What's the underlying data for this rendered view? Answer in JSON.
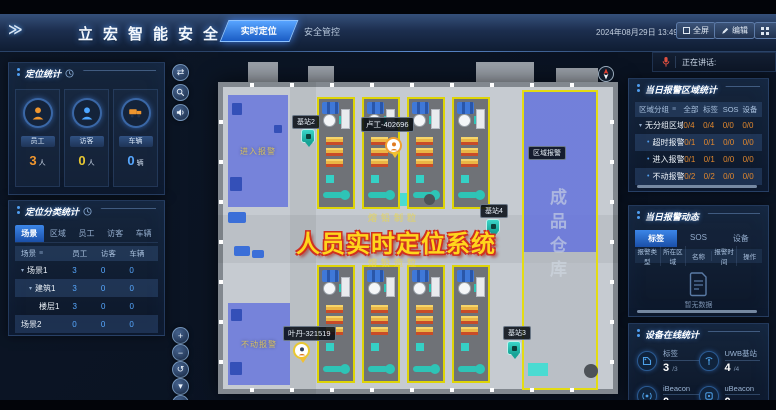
{
  "header": {
    "logo": "立宏智能安全",
    "tabs": [
      {
        "label": "实时定位"
      },
      {
        "label": "安全管控"
      }
    ],
    "datetime": "2024年08月29日 13:49:34",
    "buttons": {
      "fullscreen": "全屏",
      "edit": "编辑"
    }
  },
  "speaking": {
    "label": "正在讲话:"
  },
  "left": {
    "stats": {
      "title": "定位统计",
      "cards": [
        {
          "label": "员工",
          "value": "3",
          "unit": "人"
        },
        {
          "label": "访客",
          "value": "0",
          "unit": "人"
        },
        {
          "label": "车辆",
          "value": "0",
          "unit": "辆"
        }
      ]
    },
    "classify": {
      "title": "定位分类统计",
      "tabs": [
        "场景",
        "区域",
        "员工",
        "访客",
        "车辆"
      ],
      "columns": [
        "场景",
        "员工",
        "访客",
        "车辆"
      ],
      "rows": [
        {
          "name": "场景1",
          "e": "3",
          "v": "0",
          "c": "0"
        },
        {
          "name": "建筑1",
          "e": "3",
          "v": "0",
          "c": "0"
        },
        {
          "name": "楼层1",
          "e": "3",
          "v": "0",
          "c": "0"
        },
        {
          "name": "场景2",
          "e": "0",
          "v": "0",
          "c": "0"
        }
      ]
    }
  },
  "map": {
    "title": "人员实时定位系统",
    "zone_entry": "进入报警",
    "zone_still": "不动报警",
    "zone_area": "区域报警",
    "warehouse": "成品仓库",
    "area_label_top": "熔铅制粒",
    "area_label_bottom": "熔铅造粒",
    "station2": "基站2",
    "station3": "基站3",
    "station4": "基站4",
    "person1": "卢工-402696",
    "person2": "叶丹-321519"
  },
  "right": {
    "alarm_area": {
      "title": "当日报警区域统计",
      "columns": [
        "区域分组",
        "全部",
        "标签",
        "SOS",
        "设备"
      ],
      "rows": [
        {
          "name": "无分组区域",
          "all": "0/4",
          "tag": "0/4",
          "sos": "0/0",
          "dev": "0/0"
        },
        {
          "name": "超时报警",
          "all": "0/1",
          "tag": "0/1",
          "sos": "0/0",
          "dev": "0/0"
        },
        {
          "name": "进入报警",
          "all": "0/1",
          "tag": "0/1",
          "sos": "0/0",
          "dev": "0/0"
        },
        {
          "name": "不动报警",
          "all": "0/2",
          "tag": "0/2",
          "sos": "0/0",
          "dev": "0/0"
        }
      ]
    },
    "alarm_feed": {
      "title": "当日报警动态",
      "tabs": [
        "标签",
        "SOS",
        "设备"
      ],
      "columns": [
        "报警类型",
        "所在区域",
        "名称",
        "报警时间",
        "操作"
      ],
      "empty": "暂无数据"
    },
    "devices": {
      "title": "设备在线统计",
      "items": [
        {
          "label": "标签",
          "value": "3",
          "total": "/3"
        },
        {
          "label": "UWB基站",
          "value": "4",
          "total": "/4"
        },
        {
          "label": "iBeacon",
          "value": "0",
          "total": "/0"
        },
        {
          "label": "uBeacon",
          "value": "0",
          "total": "/0"
        }
      ]
    }
  },
  "map_controls": {
    "swap": "⇄",
    "zoom_in": "+",
    "zoom_out": "−",
    "reset": "↺",
    "caret": "▾"
  },
  "icons": {
    "menu": "≡",
    "chevrons": "≫",
    "bullet": "•",
    "arrow_down": "▾"
  },
  "colors": {
    "accent": "#2f7fe0",
    "employee": "#f0962e",
    "visitor": "#e8c832",
    "vehicle": "#57a8ff",
    "alarm_value": "#e0872e",
    "map_title": "#ffd61c",
    "zone_fill": "#6473dc"
  }
}
